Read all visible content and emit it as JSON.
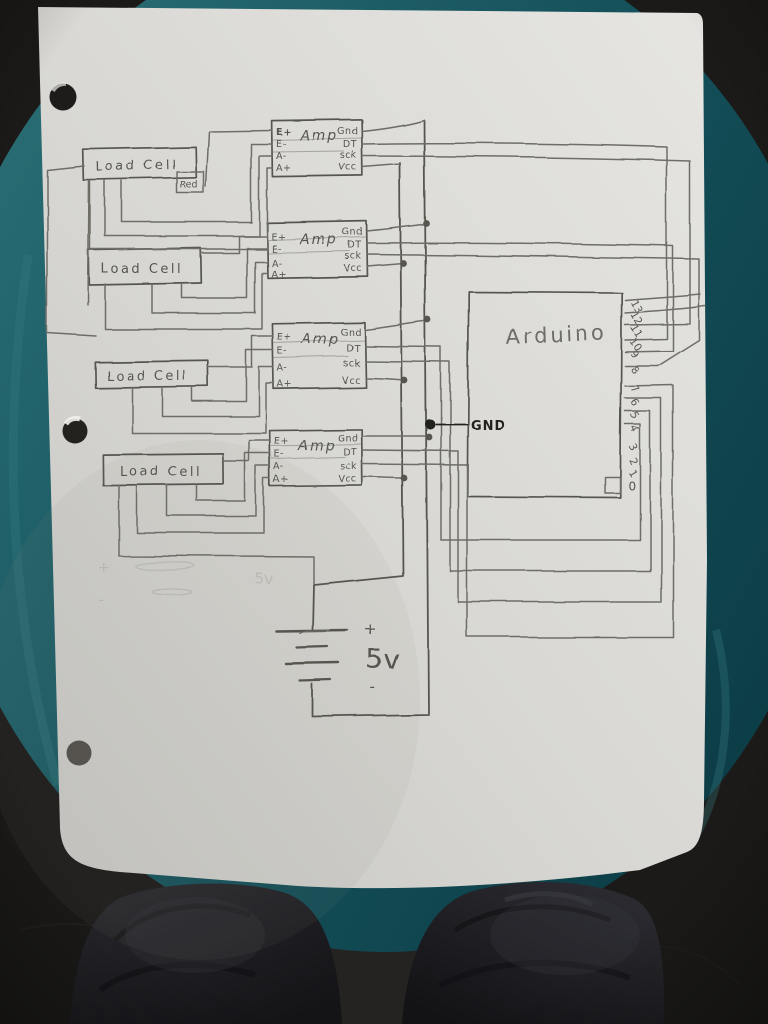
{
  "diagram": {
    "load_cells": [
      {
        "label": "Load Cell"
      },
      {
        "label": "Load Cell"
      },
      {
        "label": "Load Cell"
      },
      {
        "label": "Load Cell"
      }
    ],
    "red_tag": "Red",
    "amps": [
      {
        "label": "Amp",
        "pins_left": [
          "E+",
          "E-",
          "A-",
          "A+"
        ],
        "pins_right": [
          "Gnd",
          "DT",
          "sck",
          "Vcc"
        ]
      },
      {
        "label": "Amp",
        "pins_left": [
          "E+",
          "E-",
          "A-",
          "A+"
        ],
        "pins_right": [
          "Gnd",
          "DT",
          "sck",
          "Vcc"
        ]
      },
      {
        "label": "Amp",
        "pins_left": [
          "E+",
          "E-",
          "A-",
          "A+"
        ],
        "pins_right": [
          "Gnd",
          "DT",
          "sck",
          "Vcc"
        ]
      },
      {
        "label": "Amp",
        "pins_left": [
          "E+",
          "E-",
          "A-",
          "A+"
        ],
        "pins_right": [
          "Gnd",
          "DT",
          "sck",
          "Vcc"
        ]
      }
    ],
    "arduino": {
      "label": "Arduino",
      "pins": [
        "13",
        "12",
        "11",
        "10",
        "9",
        "8",
        "7",
        "6",
        "5",
        "4",
        "3",
        "2",
        "1",
        "0"
      ]
    },
    "power": {
      "plus": "+",
      "voltage": "5v",
      "minus": "-"
    },
    "gnd_label": "GND",
    "erased_sketch": {
      "plus": "+",
      "voltage": "5v",
      "minus": "-"
    }
  },
  "colors": {
    "pencil": "#6e6d66",
    "pencil-dark": "#575650",
    "ink": "#21201d",
    "paper-light": "#e6e5e2",
    "paper-dark": "#c6c5c2",
    "stool-light": "#2b6f75",
    "stool-mid": "#15525c",
    "stool-dark": "#0b3a43",
    "floor": "#1b1a18",
    "denim": "#232329"
  }
}
